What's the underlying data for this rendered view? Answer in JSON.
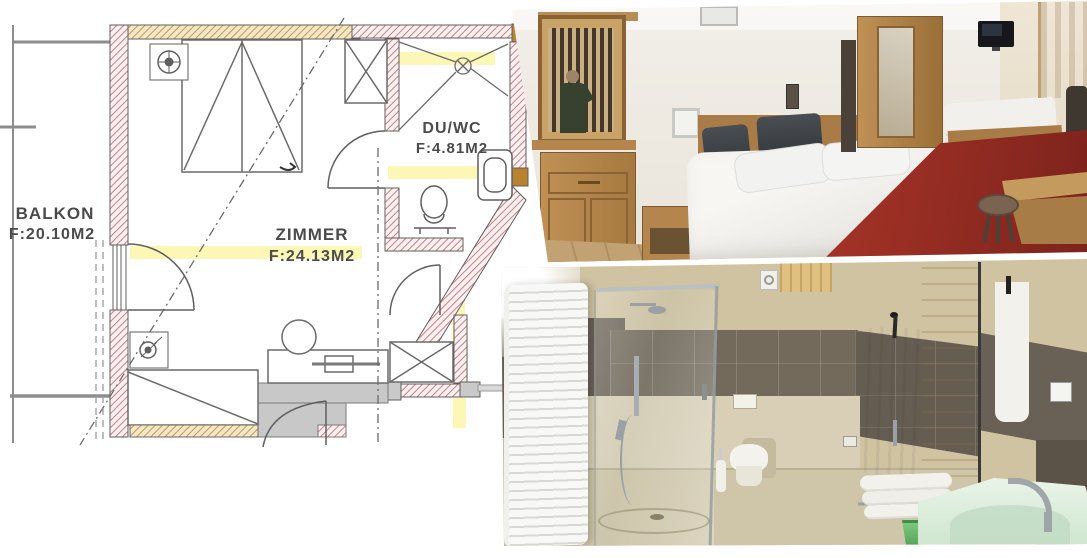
{
  "floorplan": {
    "rooms": [
      {
        "name": "BALKON",
        "area": "F:20.10M2"
      },
      {
        "name": "ZIMMER",
        "area": "F:24.13M2"
      },
      {
        "name": "DU/WC",
        "area": "F:4.81M2"
      }
    ]
  },
  "colors": {
    "wall_hatch_pink": "#c4808a",
    "wall_hatch_tan": "#c29a55",
    "highlight_yellow": "#faf078",
    "plan_line": "#5f5f5f",
    "wood": "#b5854e",
    "carpet_red": "#9e2d26",
    "headboard_dark": "#3a3e42",
    "tile_beige": "#cfc3a2",
    "tile_dark": "#6a6156",
    "sink_mint": "#d8ecd9",
    "bucket_green": "#66bb6a",
    "towel_white": "#f4f3ef"
  }
}
